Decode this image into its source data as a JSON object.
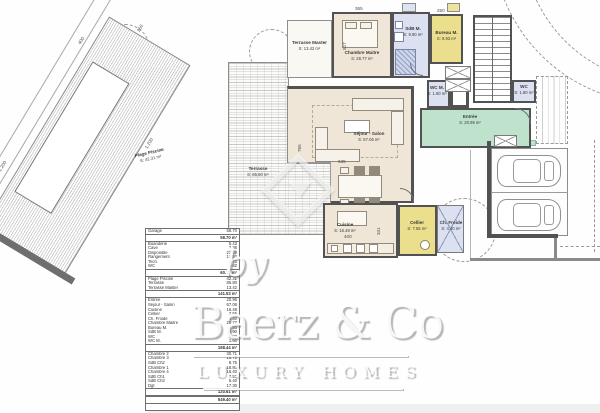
{
  "drawing": {
    "rooms": {
      "plage_piscine": {
        "name": "Plage Piscine",
        "area": "S: 42.31 m²"
      },
      "terrasse": {
        "name": "Terrasse",
        "area": "S: 85.80 m²"
      },
      "terrasse_master": {
        "name": "Terrasse Master",
        "area": "S: 13.42 m²"
      },
      "chambre_maitre": {
        "name": "Chambre Maitre",
        "area": "S: 28.77 m²"
      },
      "sdb_m": {
        "name": "SdB M.",
        "area": "S: 9.90 m²"
      },
      "bureau_m": {
        "name": "Bureau M.",
        "area": "S: 9.93 m²"
      },
      "wc_m": {
        "name": "WC M.",
        "area": "S: 1.60 m²"
      },
      "wc": {
        "name": "WC",
        "area": "S: 1.80 m²"
      },
      "entree": {
        "name": "Entrée",
        "area": "S: 20.95 m²"
      },
      "sejour": {
        "name": "Séjour - Salon",
        "area": "S: 67.06 m²"
      },
      "cuisine": {
        "name": "Cuisine",
        "area": "S: 16.48 m²"
      },
      "cellier": {
        "name": "Cellier",
        "area": "S: 7.55 m²"
      },
      "ch_froide": {
        "name": "Ch. Froide",
        "area": "S: 4.40 m²"
      }
    },
    "dimensions": {
      "top_width": "365",
      "bureau_width": "250",
      "chambre_height": "527",
      "sejour_height": "765",
      "sejour_width": "635",
      "cuisine_width": "400",
      "cuisine_height": "341",
      "pool_length_1": "1.200",
      "pool_length_2": "1.200",
      "pool_width": "400",
      "deck_width": "260"
    },
    "colors": {
      "interior_beige": "#efe6d8",
      "entry_green": "#bfe2cd",
      "wet_blue": "#dbe1f1",
      "service_yellow": "#ebdf8e",
      "wall_gray": "#525252"
    }
  },
  "surface_table": {
    "sections": [
      {
        "rows": [
          [
            "Garage",
            "58.70"
          ]
        ],
        "total": "58.70 m²"
      },
      {
        "rows": [
          [
            "Buanderie",
            "5.43"
          ],
          [
            "Cave",
            "7.36"
          ],
          [
            "Disponible",
            "22.29"
          ],
          [
            "Rangement",
            "18.52"
          ],
          [
            "Tech.",
            "4.70"
          ],
          [
            "WC",
            "1.82"
          ]
        ],
        "total": "60.12 m²"
      },
      {
        "rows": [
          [
            "Plage Piscine",
            "42.31"
          ],
          [
            "Terrasse",
            "85.80"
          ],
          [
            "Terrasse Master",
            "13.42"
          ]
        ],
        "total": "141.53 m²"
      },
      {
        "rows": [
          [
            "Entrée",
            "20.95"
          ],
          [
            "Séjour - Salon",
            "67.06"
          ],
          [
            "Cuisine",
            "16.48"
          ],
          [
            "Cellier",
            "7.55"
          ],
          [
            "Ch. Froide",
            "4.40"
          ],
          [
            "Chambre Maitre",
            "28.77"
          ],
          [
            "Bureau M.",
            "9.93"
          ],
          [
            "SdB M.",
            "9.90"
          ],
          [
            "WC",
            "1.80"
          ],
          [
            "WC M.",
            "1.60"
          ]
        ],
        "total": "168.44 m²"
      },
      {
        "rows": [
          [
            "Chambre 2",
            "30.71"
          ],
          [
            "Chambre 3",
            "15.75"
          ],
          [
            "SdB Ch2",
            "8.75"
          ],
          [
            "Chambre 1",
            "18.80"
          ],
          [
            "Chambre 4",
            "16.40"
          ],
          [
            "SdB Ch1",
            "7.50"
          ],
          [
            "SdB Ch3",
            "5.40"
          ],
          [
            "Dgt",
            "17.30"
          ]
        ],
        "total": "120.61 m²"
      },
      {
        "rows": [],
        "total": "549.40 m²"
      }
    ]
  },
  "watermark": {
    "by": "by",
    "brand": "Baerz & Co",
    "tagline": "LUXURY HOMES"
  }
}
